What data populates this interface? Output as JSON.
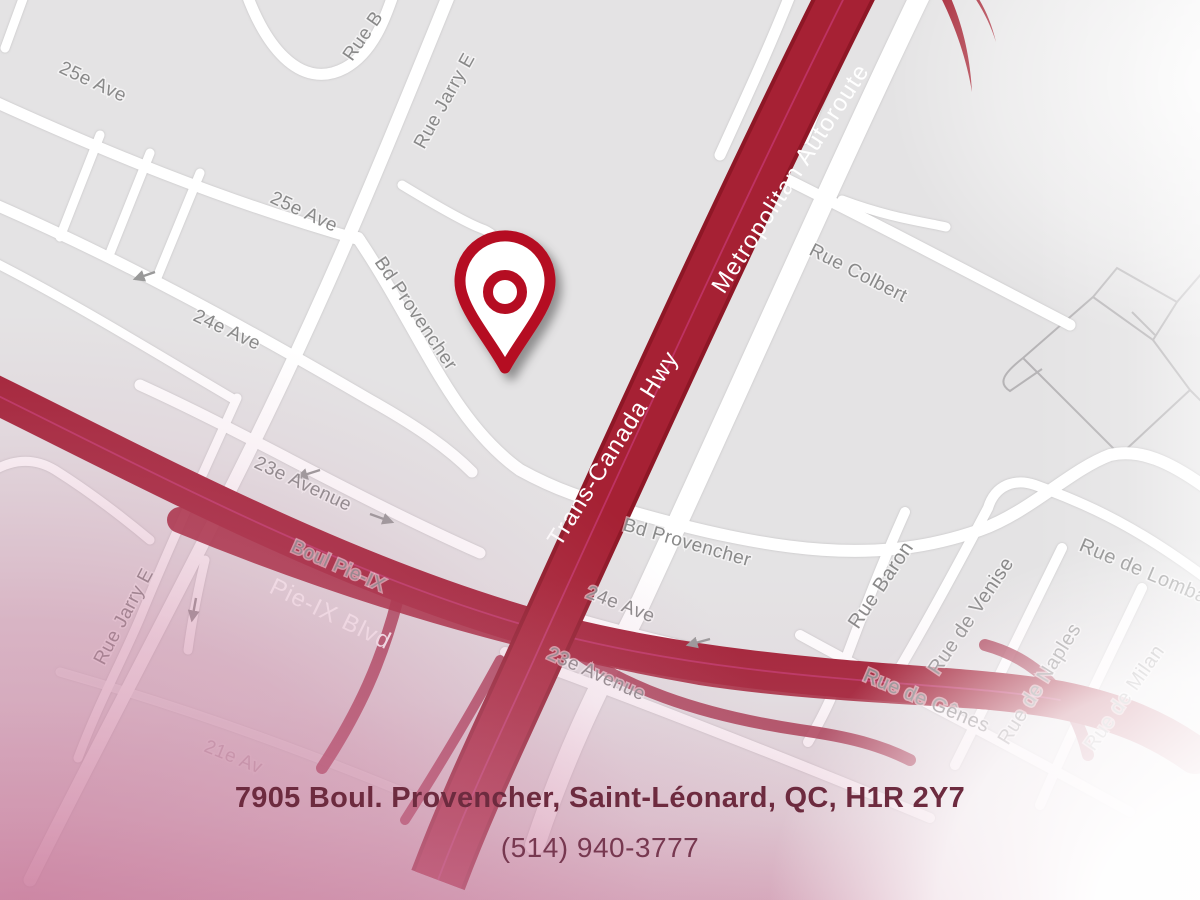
{
  "map": {
    "street_labels": [
      {
        "text": "25e Ave"
      },
      {
        "text": "Rue B"
      },
      {
        "text": "Rue Jarry E"
      },
      {
        "text": "25e Ave"
      },
      {
        "text": "24e Ave"
      },
      {
        "text": "Bd Provencher"
      },
      {
        "text": "Rue Colbert"
      },
      {
        "text": "Metropolitan Autoroute"
      },
      {
        "text": "Trans-Canada Hwy"
      },
      {
        "text": "23e Avenue"
      },
      {
        "text": "Boul Pie-IX"
      },
      {
        "text": "Pie-IX Blvd"
      },
      {
        "text": "Rue Jarry E"
      },
      {
        "text": "Bd Provencher"
      },
      {
        "text": "24e Ave"
      },
      {
        "text": "23e Avenue"
      },
      {
        "text": "Rue Baron"
      },
      {
        "text": "Rue de Venise"
      },
      {
        "text": "Rue de Naples"
      },
      {
        "text": "Rue de Gênes"
      },
      {
        "text": "Rue de Milan"
      },
      {
        "text": "Rue de Lombardie"
      },
      {
        "text": "21e Av"
      }
    ],
    "icons": {
      "location_pin": "map-pin",
      "one_way_arrow": "arrow"
    }
  },
  "contact": {
    "address": "7905 Boul. Provencher, Saint-Léonard, QC, H1R 2Y7",
    "phone": "(514) 940-3777"
  },
  "colors": {
    "map_background": "#e4e3e4",
    "road_white": "#ffffff",
    "highway_red": "#a31e2e",
    "highway_edge_red": "#8e1726",
    "transit_line_magenta": "#c2356b",
    "street_label_gray": "#898989",
    "highway_label_white": "#ffffff",
    "pin_red": "#b50e20",
    "address_maroon": "#6d2b3f",
    "phone_maroon": "#773850",
    "fog_pink": "#d8a6bc"
  }
}
